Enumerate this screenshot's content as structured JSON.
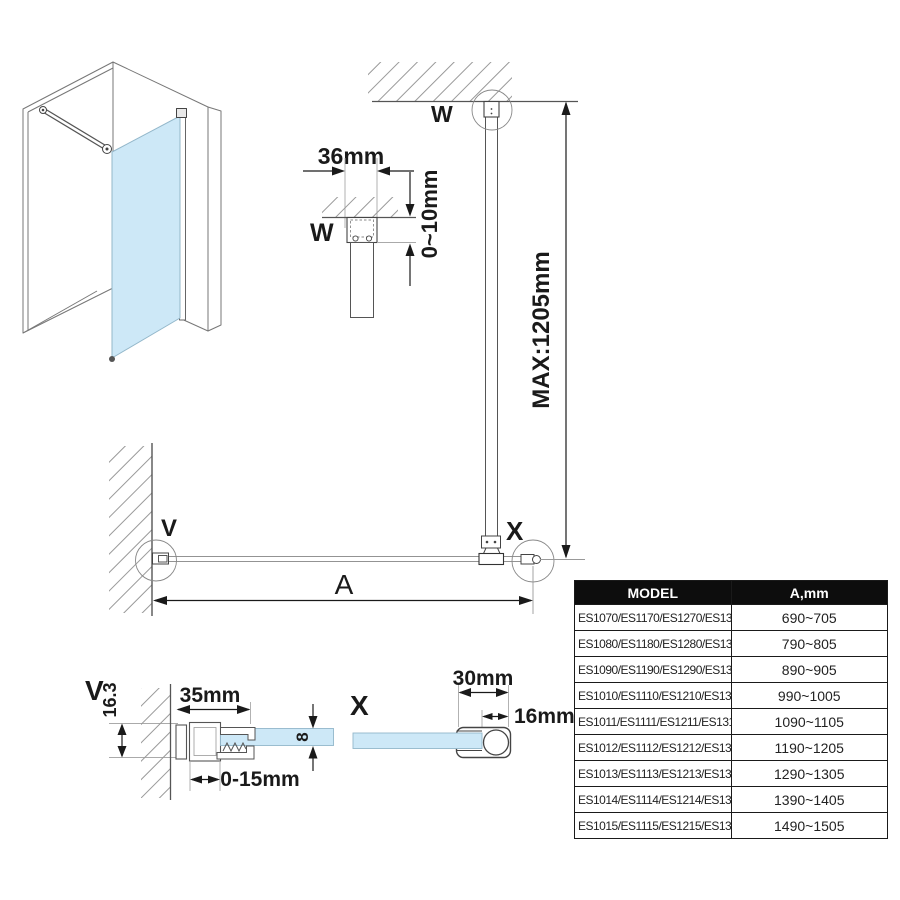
{
  "colors": {
    "glass": "#cde8f7",
    "glass_stroke": "#93b7ca",
    "line": "#555555",
    "dim_line": "#1a1a1a",
    "hatch": "#999999",
    "table_header_bg": "#0d0d0d",
    "table_header_fg": "#ffffff"
  },
  "callouts": {
    "w_top": "W",
    "w_section": "W",
    "v_plan": "V",
    "v_section": "V",
    "x_plan": "X",
    "x_section": "X"
  },
  "dims": {
    "span_label": "A",
    "top_bracket_width": "36mm",
    "ceiling_clearance": "0~10mm",
    "max_bar_length": "MAX:1205mm",
    "wall_profile_depth": "16.3",
    "wall_profile_width": "35mm",
    "wall_profile_adjustment": "0-15mm",
    "glass_thickness": "8",
    "end_clamp_width": "30mm",
    "support_bar_diameter": "16mm"
  },
  "table": {
    "headers": [
      "MODEL",
      "A,mm"
    ],
    "rows": [
      {
        "model": "ES1070/ES1170/ES1270/ES1370/ES1570",
        "a": "690~705"
      },
      {
        "model": "ES1080/ES1180/ES1280/ES1380/ES1580",
        "a": "790~805"
      },
      {
        "model": "ES1090/ES1190/ES1290/ES1390/ES1590",
        "a": "890~905"
      },
      {
        "model": "ES1010/ES1110/ES1210/ES1310/ES1510",
        "a": "990~1005"
      },
      {
        "model": "ES1011/ES1111/ES1211/ES1311/ES1511",
        "a": "1090~1105"
      },
      {
        "model": "ES1012/ES1112/ES1212/ES1312/ES1512",
        "a": "1190~1205"
      },
      {
        "model": "ES1013/ES1113/ES1213/ES1313/ES1513",
        "a": "1290~1305"
      },
      {
        "model": "ES1014/ES1114/ES1214/ES1314/ES1514",
        "a": "1390~1405"
      },
      {
        "model": "ES1015/ES1115/ES1215/ES1315/ES1515",
        "a": "1490~1505"
      }
    ]
  }
}
